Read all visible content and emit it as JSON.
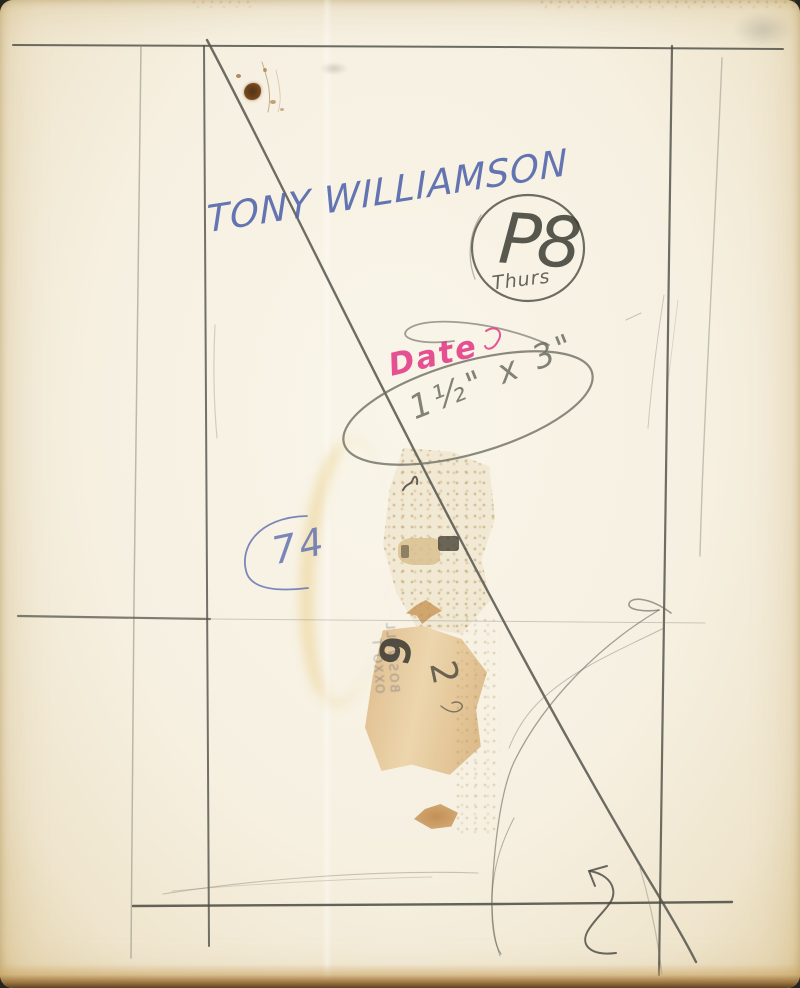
{
  "annotations": {
    "name": "TONY WILLIAMSON",
    "page_code": "P8",
    "day": "Thurs",
    "date_label": "Date",
    "size_note": "1½\" x 3\"",
    "year": "74",
    "residue": {
      "digit_a": "6",
      "digit_b": "2",
      "print_line_a": "BOSWELL",
      "print_line_b": "OXXO T"
    }
  },
  "colors": {
    "blue_ink": "#4f63ab",
    "pink_ink": "#e23a86",
    "pencil": "#54544b",
    "paper": "#f6f0e1",
    "stain_tan": "#dcb886",
    "rust_spot": "#6e431c"
  }
}
